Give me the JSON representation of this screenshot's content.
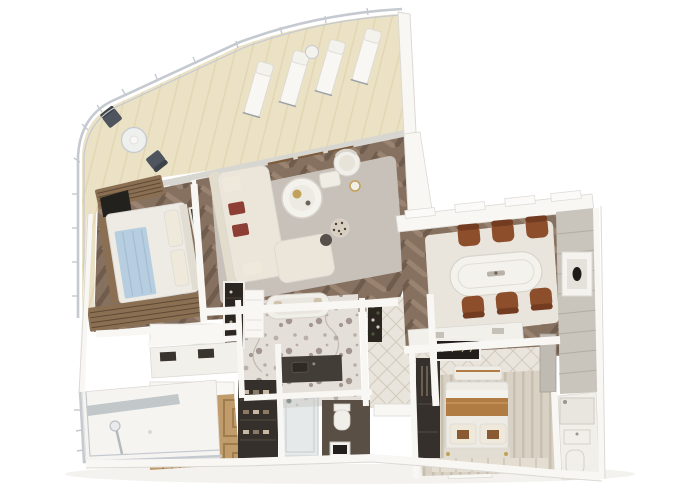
{
  "meta": {
    "kind": "3d-floorplan-render",
    "subject": "Top-down 3D cutaway floor plan of a luxury two-bedroom suite with curved wrap-around terrace",
    "canvas": {
      "width": 680,
      "height": 486
    }
  },
  "palette": {
    "background": "#ffffff",
    "deck_cream": "#ebe1c4",
    "deck_plank": "#e2d6b2",
    "deck_shade_strip": "#d8d6d1",
    "railing_gray": "#c5c9d0",
    "glass_band": "#dce1e4",
    "mullion_gray": "#9aa0a5",
    "wood_frame": "#7b5c3d",
    "wood_frame_light": "#9a7a55",
    "wall_white": "#f8f7f4",
    "wall_edge": "#dcd9d3",
    "floor_wood": "#86705f",
    "floor_wood_dark": "#6f5c4d",
    "floor_wood_light": "#9a8471",
    "rug_gray": "#c8c1ba",
    "rug_dining": "#e9e5dd",
    "sofa_cream": "#ece6da",
    "sofa_back": "#e2dccd",
    "pillow_red": "#8e3f35",
    "pillow_cream": "#efe9dc",
    "table_white": "#f4f2ed",
    "table_edge": "#d8d4cc",
    "gold_accent": "#c2a159",
    "marble_floor": "#e5dfd9",
    "marble_fleck_mid": "#b9aea8",
    "marble_fleck_dark": "#a2968f",
    "counter_dark": "#433d37",
    "green_marble": "#2f3428",
    "tv_black": "#23211d",
    "bed_white": "#edebe4",
    "bed_headboard": "#e2ddd2",
    "throw_blue": "#b7cde0",
    "throw_blue_fold": "#a3bdd2",
    "blanket_tan": "#b07c44",
    "pillow_brown_square": "#8a5a33",
    "wood_slat": "#8a6f52",
    "wood_slat_dark": "#5e4a36",
    "parquet_base": "#c09b6b",
    "parquet_line": "#a07b4c",
    "closet_dark": "#35302b",
    "bar_dark": "#2c2620",
    "chair_leather": "#8d4e2c",
    "chair_leather_dark": "#733c20",
    "panel_gray": "#c9c4bc",
    "panel_line": "#b2ada4",
    "carpet_beige": "#d8d1c4",
    "carpet_stripe": "#c7bfb0",
    "tile_light": "#e9e4dc",
    "tile_line": "#d2cabd",
    "fixture_white": "#f1efe9",
    "fixture_edge": "#d5d1c9",
    "wc_floor_dark": "#5a4f45",
    "art_dark": "#211e1b",
    "glass_shower": "#cdd4d4",
    "leopard_base": "#d8cfc0",
    "leopard_spot": "#4a4038",
    "shadow": "#e9e7e2"
  },
  "rooms": [
    {
      "id": "terrace",
      "label": "wrap-around terrace",
      "items": [
        "4 sun loungers",
        "round side table",
        "bistro table",
        "2 bistro chairs",
        "curved glass railing",
        "sliding window wall"
      ]
    },
    {
      "id": "living-room",
      "label": "living room",
      "items": [
        "l-shaped cream sofa",
        "red accent pillows",
        "round coffee table with gold tray",
        "armchair",
        "ottoman",
        "leopard pouf",
        "side stool",
        "gray area rug",
        "green marble feature panel",
        "chevron wood floor"
      ]
    },
    {
      "id": "master-bedroom",
      "label": "master bedroom",
      "items": [
        "bed with blue throw",
        "wall tv",
        "wood slat benches"
      ]
    },
    {
      "id": "master-bathroom",
      "label": "master bathroom",
      "items": [
        "bathtub",
        "dark double vanity",
        "linen shelf",
        "minibar niche",
        "marble floor"
      ]
    },
    {
      "id": "dressing-room",
      "label": "dressing room",
      "items": [
        "vanity counter",
        "shoe shelves",
        "parquet floor"
      ]
    },
    {
      "id": "shower-wc",
      "label": "shower and wc",
      "items": [
        "glass shower",
        "toilet",
        "framed art"
      ]
    },
    {
      "id": "entry-hall",
      "label": "entry hall",
      "items": [
        "wine rack",
        "entry door",
        "tiled floor",
        "entry step"
      ]
    },
    {
      "id": "dining-room",
      "label": "dining room",
      "items": [
        "oval white dining table",
        "6 leather dining chairs",
        "sideboard",
        "paneled wall with oval art",
        "light rug",
        "dark framed art"
      ]
    },
    {
      "id": "second-bedroom",
      "label": "second bedroom",
      "items": [
        "bed with tan blanket band",
        "foot bench",
        "dark wardrobe",
        "striped carpet",
        "runner rug"
      ]
    },
    {
      "id": "second-bathroom",
      "label": "second bathroom",
      "items": [
        "shower",
        "vanity",
        "toilet"
      ]
    },
    {
      "id": "side-balcony",
      "label": "side balcony",
      "items": [
        "outdoor shower",
        "white railing",
        "glass screen"
      ]
    }
  ]
}
